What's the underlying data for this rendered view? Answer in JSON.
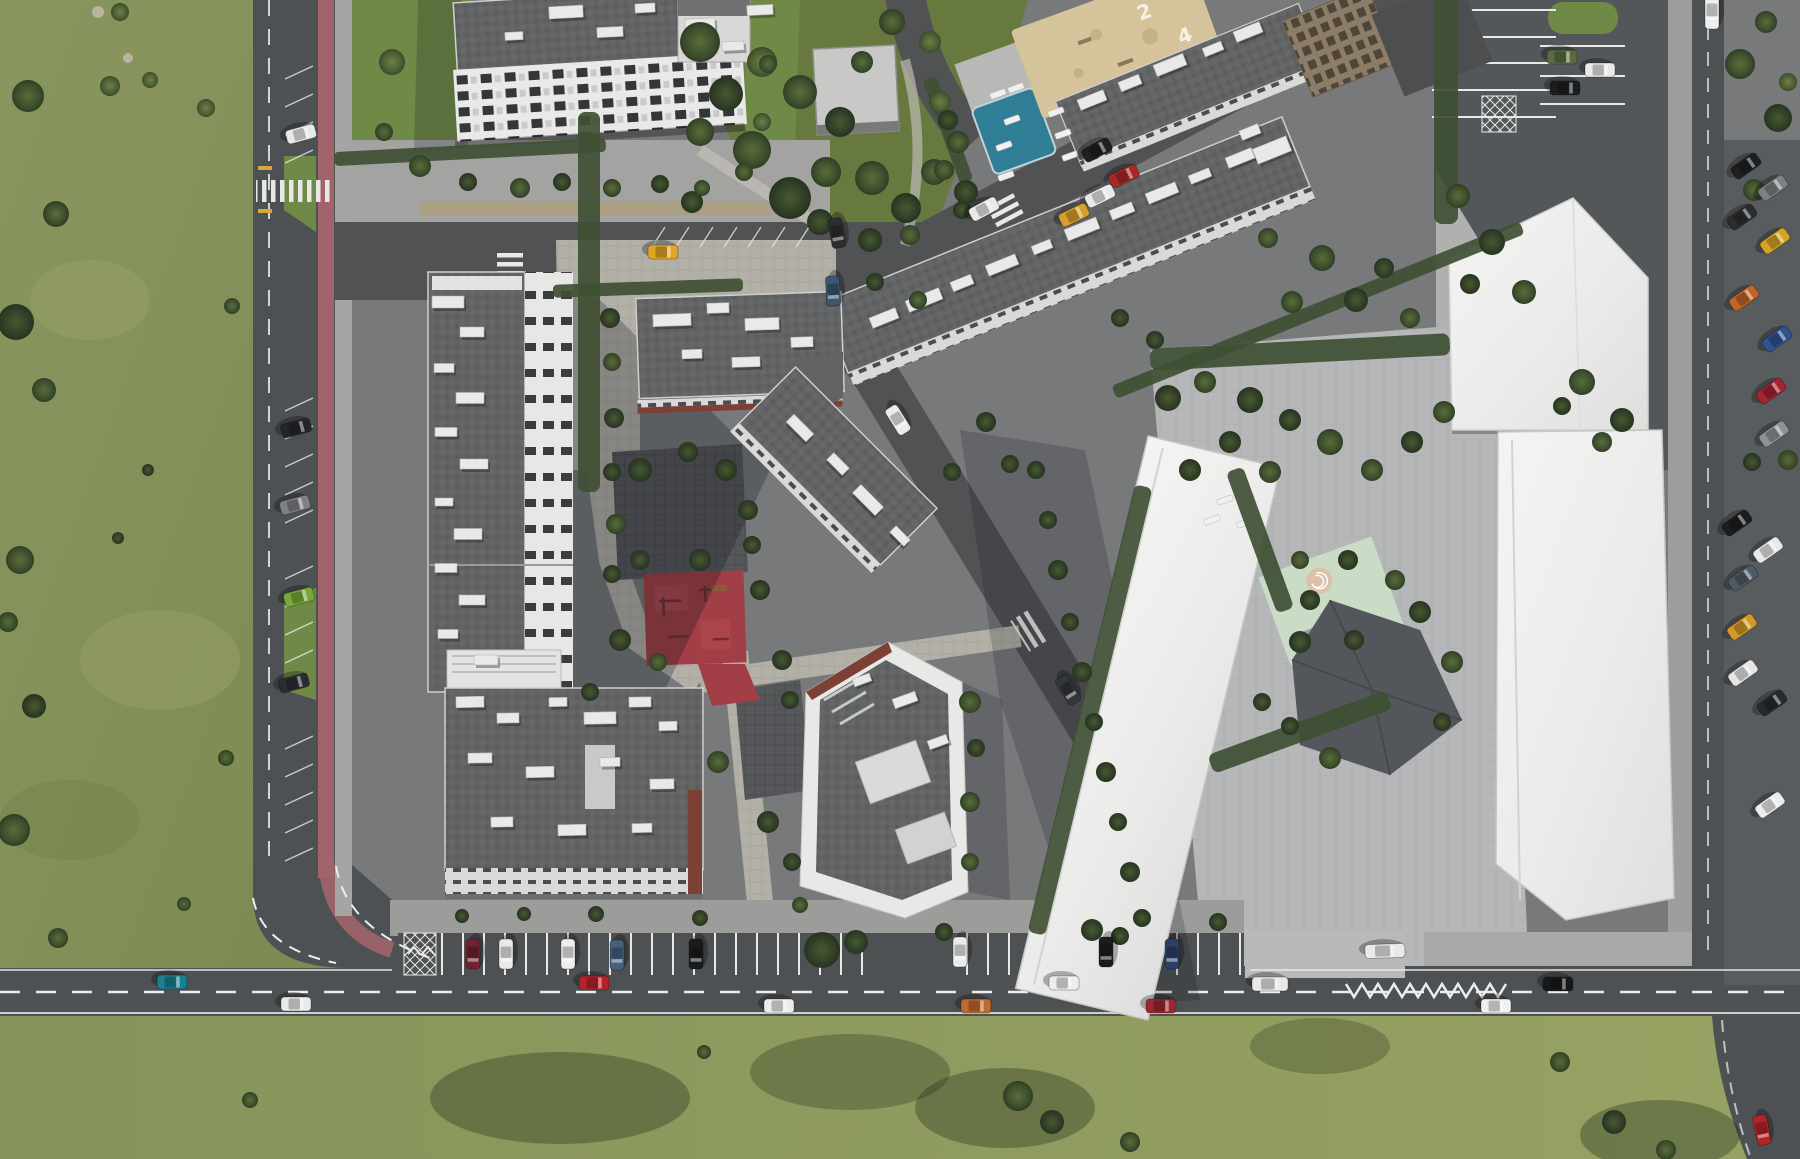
{
  "meta": {
    "title": "Aerial top-down render of a residential block masterplan"
  },
  "labels": {
    "sand_number_a": "2",
    "sand_number_b": "4"
  },
  "palette": {
    "field": "#87945c",
    "fieldDark": "#76844c",
    "fieldBottom": "#8f9c5f",
    "garden": "#68793f",
    "lawn": "#6f8a46",
    "road": "#4e5153",
    "roadLight": "#5a5d5f",
    "estate": "#77797b",
    "plaza": "#6e7072",
    "sidewalk": "#a5a5a3",
    "paver": "#b3b0a8",
    "paverLight": "#c0bdb5",
    "tactile": "#ada081",
    "bike": "#a2636a",
    "white": "#ededec",
    "roofD": "#616365",
    "brick": "#7c4034",
    "pool": "#2f7e95",
    "sand": "#d5c49b",
    "red": "#a23e45",
    "mint": "#cadbc6",
    "marking": "#eceded",
    "hedge": "#3f4f33",
    "concrete": "#b6b7b9",
    "darkPaver": "#55575a",
    "tan": "#8d7d68"
  },
  "trees": [
    [
      28,
      96,
      16,
      2
    ],
    [
      56,
      214,
      13,
      2
    ],
    [
      16,
      322,
      18,
      1
    ],
    [
      44,
      390,
      12,
      2
    ],
    [
      110,
      86,
      10,
      3
    ],
    [
      150,
      80,
      8,
      3
    ],
    [
      20,
      560,
      14,
      2
    ],
    [
      8,
      622,
      10,
      2
    ],
    [
      34,
      706,
      12,
      1
    ],
    [
      14,
      830,
      16,
      2
    ],
    [
      148,
      470,
      6,
      1
    ],
    [
      118,
      538,
      6,
      1
    ],
    [
      206,
      108,
      9,
      3
    ],
    [
      232,
      306,
      8,
      2
    ],
    [
      58,
      938,
      10,
      2
    ],
    [
      226,
      758,
      8,
      2
    ],
    [
      184,
      904,
      7,
      2
    ],
    [
      120,
      12,
      9,
      3
    ],
    [
      700,
      42,
      20,
      2
    ],
    [
      726,
      94,
      17,
      1
    ],
    [
      752,
      150,
      19,
      2
    ],
    [
      790,
      198,
      21,
      1
    ],
    [
      826,
      172,
      15,
      2
    ],
    [
      762,
      62,
      15,
      3
    ],
    [
      800,
      92,
      17,
      2
    ],
    [
      840,
      122,
      15,
      1
    ],
    [
      872,
      178,
      17,
      2
    ],
    [
      906,
      208,
      15,
      1
    ],
    [
      934,
      172,
      13,
      2
    ],
    [
      820,
      222,
      13,
      1
    ],
    [
      700,
      132,
      14,
      2
    ],
    [
      940,
      102,
      11,
      3
    ],
    [
      958,
      142,
      11,
      2
    ],
    [
      692,
      202,
      11,
      1
    ],
    [
      862,
      62,
      11,
      2
    ],
    [
      892,
      22,
      13,
      2
    ],
    [
      930,
      42,
      11,
      3
    ],
    [
      966,
      192,
      12,
      1
    ],
    [
      870,
      240,
      12,
      1
    ],
    [
      910,
      235,
      10,
      2
    ],
    [
      392,
      62,
      13,
      3
    ],
    [
      384,
      132,
      9,
      2
    ],
    [
      420,
      166,
      11,
      2
    ],
    [
      468,
      182,
      9,
      1
    ],
    [
      520,
      188,
      10,
      2
    ],
    [
      562,
      182,
      9,
      1
    ],
    [
      612,
      188,
      9,
      2
    ],
    [
      660,
      184,
      9,
      1
    ],
    [
      702,
      188,
      8,
      2
    ],
    [
      744,
      172,
      9,
      2
    ],
    [
      762,
      122,
      9,
      3
    ],
    [
      768,
      64,
      9,
      2
    ],
    [
      610,
      318,
      10,
      1
    ],
    [
      612,
      362,
      9,
      2
    ],
    [
      614,
      418,
      10,
      1
    ],
    [
      612,
      472,
      9,
      1
    ],
    [
      616,
      524,
      10,
      2
    ],
    [
      612,
      574,
      9,
      1
    ],
    [
      620,
      640,
      11,
      1
    ],
    [
      658,
      662,
      9,
      2
    ],
    [
      590,
      692,
      9,
      1
    ],
    [
      640,
      470,
      12,
      1
    ],
    [
      688,
      452,
      10,
      1
    ],
    [
      726,
      470,
      11,
      1
    ],
    [
      748,
      510,
      10,
      1
    ],
    [
      640,
      560,
      10,
      1
    ],
    [
      700,
      560,
      11,
      1
    ],
    [
      752,
      545,
      9,
      1
    ],
    [
      760,
      590,
      10,
      1
    ],
    [
      718,
      762,
      11,
      2
    ],
    [
      768,
      822,
      11,
      1
    ],
    [
      782,
      660,
      10,
      1
    ],
    [
      790,
      700,
      9,
      1
    ],
    [
      970,
      702,
      11,
      2
    ],
    [
      976,
      748,
      9,
      1
    ],
    [
      970,
      802,
      10,
      2
    ],
    [
      792,
      862,
      9,
      1
    ],
    [
      970,
      862,
      9,
      2
    ],
    [
      800,
      905,
      8,
      2
    ],
    [
      875,
      282,
      9,
      1
    ],
    [
      918,
      300,
      9,
      2
    ],
    [
      1120,
      318,
      9,
      1
    ],
    [
      1155,
      340,
      9,
      1
    ],
    [
      1322,
      258,
      13,
      2
    ],
    [
      1356,
      300,
      12,
      1
    ],
    [
      1292,
      302,
      11,
      2
    ],
    [
      1384,
      268,
      10,
      1
    ],
    [
      1268,
      238,
      10,
      2
    ],
    [
      1410,
      318,
      10,
      2
    ],
    [
      1458,
      196,
      12,
      2
    ],
    [
      1492,
      242,
      13,
      1
    ],
    [
      1524,
      292,
      12,
      2
    ],
    [
      1470,
      284,
      10,
      1
    ],
    [
      1168,
      398,
      13,
      1
    ],
    [
      1205,
      382,
      11,
      2
    ],
    [
      1250,
      400,
      13,
      1
    ],
    [
      1290,
      420,
      11,
      1
    ],
    [
      1330,
      442,
      13,
      2
    ],
    [
      1230,
      442,
      11,
      1
    ],
    [
      1270,
      472,
      11,
      2
    ],
    [
      1190,
      470,
      11,
      1
    ],
    [
      1372,
      470,
      11,
      2
    ],
    [
      1412,
      442,
      11,
      1
    ],
    [
      1444,
      412,
      11,
      2
    ],
    [
      1300,
      642,
      11,
      1
    ],
    [
      1262,
      702,
      9,
      1
    ],
    [
      1330,
      758,
      11,
      2
    ],
    [
      1290,
      726,
      9,
      1
    ],
    [
      1420,
      612,
      11,
      1
    ],
    [
      1452,
      662,
      11,
      2
    ],
    [
      1442,
      722,
      9,
      1
    ],
    [
      1348,
      560,
      10,
      1
    ],
    [
      1395,
      580,
      10,
      2
    ],
    [
      1582,
      382,
      13,
      2
    ],
    [
      1622,
      420,
      12,
      1
    ],
    [
      1602,
      442,
      10,
      2
    ],
    [
      1562,
      406,
      9,
      1
    ],
    [
      1740,
      64,
      15,
      2
    ],
    [
      1778,
      118,
      14,
      1
    ],
    [
      1754,
      190,
      11,
      2
    ],
    [
      1788,
      82,
      9,
      3
    ],
    [
      1766,
      22,
      11,
      2
    ],
    [
      1788,
      460,
      10,
      2
    ],
    [
      1752,
      462,
      9,
      1
    ],
    [
      1048,
      520,
      9,
      1
    ],
    [
      1058,
      570,
      10,
      1
    ],
    [
      1070,
      622,
      9,
      1
    ],
    [
      1082,
      672,
      10,
      1
    ],
    [
      1094,
      722,
      9,
      1
    ],
    [
      1106,
      772,
      10,
      1
    ],
    [
      1118,
      822,
      9,
      1
    ],
    [
      1130,
      872,
      10,
      1
    ],
    [
      1142,
      918,
      9,
      1
    ],
    [
      1036,
      470,
      9,
      1
    ],
    [
      986,
      422,
      10,
      1
    ],
    [
      1010,
      464,
      9,
      1
    ],
    [
      952,
      472,
      9,
      1
    ],
    [
      822,
      950,
      18,
      1
    ],
    [
      856,
      942,
      12,
      1
    ],
    [
      1092,
      930,
      11,
      1
    ],
    [
      1120,
      936,
      9,
      1
    ],
    [
      944,
      932,
      9,
      1
    ],
    [
      700,
      918,
      8,
      1
    ],
    [
      596,
      914,
      8,
      1
    ],
    [
      524,
      914,
      7,
      1
    ],
    [
      462,
      916,
      7,
      1
    ],
    [
      1218,
      922,
      9,
      1
    ],
    [
      1018,
      1096,
      15,
      2
    ],
    [
      1052,
      1122,
      12,
      1
    ],
    [
      1130,
      1142,
      10,
      2
    ],
    [
      1560,
      1062,
      10,
      2
    ],
    [
      1614,
      1122,
      12,
      1
    ],
    [
      1666,
      1150,
      10,
      2
    ],
    [
      704,
      1052,
      7,
      2
    ],
    [
      250,
      1100,
      8,
      2
    ],
    [
      948,
      120,
      10,
      1
    ],
    [
      944,
      170,
      10,
      2
    ],
    [
      962,
      210,
      9,
      1
    ],
    [
      1310,
      600,
      10,
      1
    ],
    [
      1354,
      640,
      10,
      1
    ],
    [
      1300,
      560,
      9,
      2
    ]
  ],
  "hedges": [
    [
      589,
      302,
      22,
      380,
      0
    ],
    [
      648,
      288,
      190,
      13,
      -2
    ],
    [
      470,
      152,
      272,
      14,
      -3
    ],
    [
      1090,
      710,
      18,
      460,
      13.5
    ],
    [
      1300,
      352,
      300,
      22,
      -3
    ],
    [
      1446,
      86,
      24,
      276,
      0
    ],
    [
      1260,
      540,
      18,
      150,
      -20
    ],
    [
      1300,
      732,
      190,
      20,
      -20
    ],
    [
      1318,
      310,
      440,
      14,
      -22
    ],
    [
      948,
      130,
      14,
      110,
      -20
    ]
  ],
  "roof_boxes": [
    [
      566,
      12,
      34,
      12,
      -3
    ],
    [
      610,
      32,
      26,
      10,
      -3
    ],
    [
      645,
      8,
      20,
      9,
      -3
    ],
    [
      700,
      24,
      30,
      11,
      -3
    ],
    [
      733,
      46,
      22,
      9,
      -3
    ],
    [
      514,
      36,
      18,
      8,
      -3
    ],
    [
      760,
      10,
      26,
      10,
      -3
    ],
    [
      884,
      318,
      28,
      11,
      -22
    ],
    [
      924,
      300,
      36,
      12,
      -22
    ],
    [
      962,
      283,
      22,
      10,
      -22
    ],
    [
      1002,
      265,
      32,
      11,
      -22
    ],
    [
      1042,
      247,
      20,
      9,
      -22
    ],
    [
      1082,
      229,
      34,
      12,
      -22
    ],
    [
      1122,
      211,
      24,
      10,
      -22
    ],
    [
      1162,
      193,
      32,
      11,
      -22
    ],
    [
      1200,
      176,
      22,
      9,
      -22
    ],
    [
      1240,
      158,
      28,
      11,
      -22
    ],
    [
      1272,
      150,
      36,
      16,
      -22
    ],
    [
      1250,
      132,
      20,
      10,
      -22
    ],
    [
      1092,
      100,
      28,
      11,
      -22
    ],
    [
      1130,
      83,
      22,
      10,
      -22
    ],
    [
      1170,
      65,
      32,
      12,
      -22
    ],
    [
      1213,
      49,
      20,
      9,
      -22
    ],
    [
      1248,
      32,
      28,
      11,
      -22
    ],
    [
      448,
      302,
      32,
      12,
      0
    ],
    [
      472,
      332,
      24,
      10,
      0
    ],
    [
      444,
      368,
      20,
      9,
      0
    ],
    [
      470,
      398,
      28,
      11,
      0
    ],
    [
      446,
      432,
      22,
      9,
      0
    ],
    [
      474,
      464,
      28,
      10,
      0
    ],
    [
      444,
      502,
      18,
      8,
      0
    ],
    [
      468,
      534,
      28,
      11,
      0
    ],
    [
      446,
      568,
      22,
      9,
      0
    ],
    [
      472,
      600,
      26,
      10,
      0
    ],
    [
      448,
      634,
      20,
      9,
      0
    ],
    [
      486,
      660,
      24,
      10,
      0
    ],
    [
      672,
      320,
      38,
      12,
      -2
    ],
    [
      718,
      308,
      22,
      10,
      -2
    ],
    [
      762,
      324,
      34,
      12,
      -2
    ],
    [
      692,
      354,
      20,
      9,
      -2
    ],
    [
      746,
      362,
      28,
      10,
      -2
    ],
    [
      802,
      342,
      22,
      10,
      -2
    ],
    [
      800,
      428,
      28,
      11,
      45
    ],
    [
      838,
      464,
      22,
      10,
      45
    ],
    [
      868,
      500,
      32,
      12,
      45
    ],
    [
      900,
      536,
      20,
      9,
      45
    ],
    [
      470,
      702,
      28,
      11,
      -1
    ],
    [
      508,
      718,
      22,
      10,
      -1
    ],
    [
      558,
      702,
      18,
      9,
      -1
    ],
    [
      600,
      718,
      32,
      12,
      -1
    ],
    [
      640,
      702,
      22,
      10,
      -1
    ],
    [
      668,
      726,
      18,
      9,
      -1
    ],
    [
      480,
      758,
      24,
      10,
      -1
    ],
    [
      540,
      772,
      28,
      11,
      -1
    ],
    [
      610,
      762,
      20,
      9,
      -1
    ],
    [
      662,
      784,
      24,
      10,
      -1
    ],
    [
      502,
      822,
      22,
      10,
      -1
    ],
    [
      572,
      830,
      28,
      11,
      -1
    ],
    [
      642,
      828,
      20,
      9,
      -1
    ],
    [
      905,
      700,
      24,
      10,
      -20
    ],
    [
      938,
      742,
      20,
      9,
      -20
    ],
    [
      862,
      680,
      18,
      8,
      -20
    ]
  ],
  "loungers": [
    [
      1056,
      112,
      -20
    ],
    [
      1063,
      134,
      -20
    ],
    [
      1070,
      156,
      -20
    ],
    [
      998,
      94,
      -20
    ],
    [
      1016,
      88,
      -20
    ],
    [
      1006,
      176,
      -20
    ],
    [
      1012,
      120,
      -20
    ],
    [
      1004,
      146,
      -20
    ],
    [
      1225,
      500,
      -20
    ],
    [
      1212,
      520,
      -20
    ],
    [
      1245,
      523,
      -20
    ]
  ],
  "cars": [
    [
      172,
      982,
      0,
      "#1a7f90"
    ],
    [
      296,
      1004,
      0,
      "#e9e9e9"
    ],
    [
      594,
      983,
      0,
      "#b3232a"
    ],
    [
      779,
      1006,
      0,
      "#ececec"
    ],
    [
      976,
      1006,
      0,
      "#bf6a2e"
    ],
    [
      1064,
      983,
      0,
      "#ededed"
    ],
    [
      1161,
      1006,
      0,
      "#9c2730"
    ],
    [
      1270,
      984,
      0,
      "#e8e8e8",
      36
    ],
    [
      1558,
      984,
      0,
      "#17191b"
    ],
    [
      1496,
      1006,
      0,
      "#f0f0f0"
    ],
    [
      1762,
      1130,
      78,
      "#b02426"
    ],
    [
      301,
      134,
      -15,
      "#e8e8e8"
    ],
    [
      296,
      428,
      -15,
      "#24262a"
    ],
    [
      295,
      505,
      -15,
      "#7e8184"
    ],
    [
      299,
      597,
      -15,
      "#79a83a"
    ],
    [
      294,
      683,
      -15,
      "#2a2c30"
    ],
    [
      663,
      252,
      0,
      "#e0a524"
    ],
    [
      837,
      233,
      80,
      "#2b2d2f"
    ],
    [
      833,
      291,
      87,
      "#3d556e"
    ],
    [
      984,
      209,
      -28,
      "#e9e9e9"
    ],
    [
      1097,
      150,
      -28,
      "#1d1f22"
    ],
    [
      898,
      420,
      58,
      "#ececec"
    ],
    [
      1068,
      690,
      58,
      "#33363a"
    ],
    [
      1124,
      176,
      -26,
      "#a82828"
    ],
    [
      1100,
      196,
      -26,
      "#e8e8e8"
    ],
    [
      1074,
      215,
      -26,
      "#d6a02a"
    ],
    [
      1562,
      57,
      0,
      "#5a6b42"
    ],
    [
      1600,
      70,
      0,
      "#e9e9e9"
    ],
    [
      1565,
      88,
      0,
      "#1b1d1f"
    ],
    [
      473,
      954,
      90,
      "#6e2430"
    ],
    [
      506,
      954,
      90,
      "#e9e9e9"
    ],
    [
      568,
      954,
      90,
      "#ededed"
    ],
    [
      617,
      955,
      90,
      "#46617c"
    ],
    [
      696,
      954,
      90,
      "#191b1d"
    ],
    [
      960,
      952,
      90,
      "#eaeaea"
    ],
    [
      1106,
      952,
      90,
      "#1a1c1e"
    ],
    [
      1172,
      954,
      90,
      "#2c3f66"
    ],
    [
      1746,
      166,
      -35,
      "#1d1f21"
    ],
    [
      1773,
      188,
      -35,
      "#7e8184"
    ],
    [
      1742,
      217,
      -35,
      "#2a2c2e"
    ],
    [
      1775,
      241,
      -35,
      "#d4a426"
    ],
    [
      1744,
      298,
      -35,
      "#c06529"
    ],
    [
      1777,
      339,
      -35,
      "#2e5390"
    ],
    [
      1771,
      391,
      -35,
      "#a32531"
    ],
    [
      1774,
      434,
      -35,
      "#8f9295"
    ],
    [
      1737,
      523,
      -35,
      "#1b1d1f"
    ],
    [
      1768,
      550,
      -35,
      "#e8e8e8"
    ],
    [
      1743,
      578,
      -35,
      "#4f5c68"
    ],
    [
      1742,
      627,
      -35,
      "#d09a26"
    ],
    [
      1743,
      673,
      -35,
      "#e6e6e6"
    ],
    [
      1772,
      703,
      -35,
      "#27292b"
    ],
    [
      1770,
      805,
      -35,
      "#ececec"
    ],
    [
      1385,
      951,
      -2,
      "#e9e9e8",
      40
    ],
    [
      1712,
      12,
      90,
      "#eeeeee",
      34
    ]
  ],
  "left_bay_marks": [
    66,
    94,
    122,
    150,
    398,
    426,
    454,
    482,
    510,
    566,
    594,
    622,
    650,
    736,
    764,
    792,
    820,
    848
  ],
  "s1_bay_marks": [
    652,
    676,
    700,
    724,
    748,
    772,
    796
  ]
}
